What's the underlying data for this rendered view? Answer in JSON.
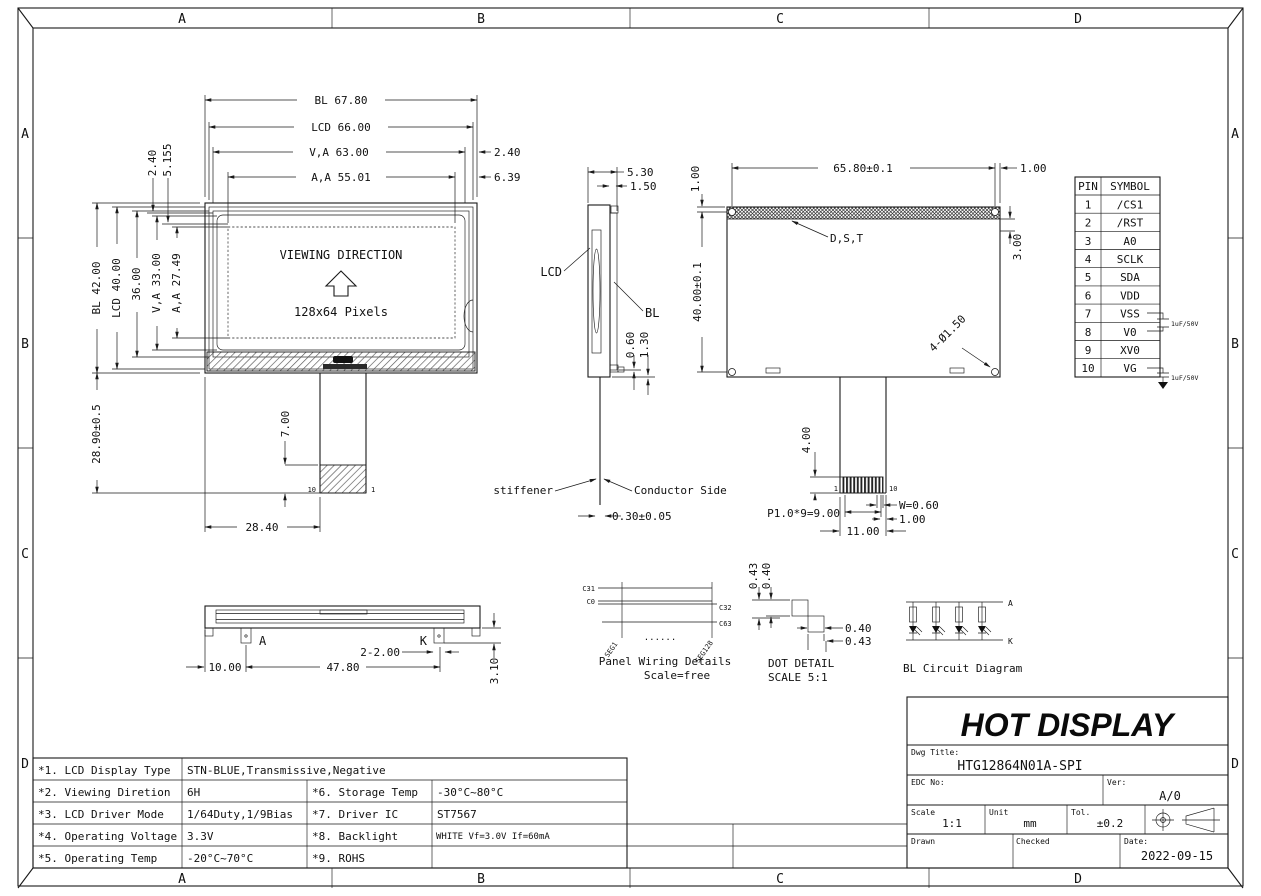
{
  "colors": {
    "line": "#1a1a1a",
    "paper": "#ffffff"
  },
  "border": {
    "letters": [
      "A",
      "B",
      "C",
      "D"
    ]
  },
  "front_view": {
    "dim_bl_w": "BL 67.80",
    "dim_lcd_w": "LCD 66.00",
    "dim_va_w": "V,A 63.00",
    "dim_aa_w": "A,A 55.01",
    "dim_240_right": "2.40",
    "dim_639": "6.39",
    "dim_bl_h": "BL 42.00",
    "dim_lcd_h": "LCD 40.00",
    "dim_36": "36.00",
    "dim_va_h": "V,A 33.00",
    "dim_aa_h": "A,A 27.49",
    "dim_240_top": "2.40",
    "dim_5155": "5.155",
    "dim_2890": "28.90±0.5",
    "dim_700": "7.00",
    "dim_2840": "28.40",
    "viewing_direction": "VIEWING DIRECTION",
    "pixels": "128x64 Pixels",
    "pin10": "10",
    "pin1": "1"
  },
  "side_view": {
    "dim_530": "5.30",
    "dim_150": "1.50",
    "label_lcd": "LCD",
    "label_bl": "BL",
    "dim_060": "0.60",
    "dim_130": "1.30",
    "label_stiffener": "stiffener",
    "label_conductor": "Conductor Side",
    "dim_030": "0.30±0.05"
  },
  "rear_view": {
    "dim_6580": "65.80±0.1",
    "dim_100_tr": "1.00",
    "dim_100_tl": "1.00",
    "dim_4000": "40.00±0.1",
    "dim_300": "3.00",
    "label_dst": "D,S,T",
    "dim_holes": "4-Ø1.50",
    "dim_400": "4.00",
    "pin1": "1",
    "pin10": "10",
    "dim_w": "W=0.60",
    "dim_pitch": "P1.0*9=9.00",
    "dim_100_b": "1.00",
    "dim_1100": "11.00"
  },
  "pin_table": {
    "headers": [
      "PIN",
      "SYMBOL"
    ],
    "rows": [
      [
        "1",
        "/CS1"
      ],
      [
        "2",
        "/RST"
      ],
      [
        "3",
        "A0"
      ],
      [
        "4",
        "SCLK"
      ],
      [
        "5",
        "SDA"
      ],
      [
        "6",
        "VDD"
      ],
      [
        "7",
        "VSS"
      ],
      [
        "8",
        "V0"
      ],
      [
        "9",
        "XV0"
      ],
      [
        "10",
        "VG"
      ]
    ],
    "cap_89": "1uF/50V",
    "cap_10": "1uF/50V"
  },
  "bottom_view": {
    "label_a": "A",
    "label_k": "K",
    "dim_1000": "10.00",
    "dim_4780": "47.80",
    "dim_2200": "2-2.00",
    "dim_310": "3.10"
  },
  "panel_wiring": {
    "c31": "C31",
    "c0": "C0",
    "c32": "C32",
    "c63": "C63",
    "seg1": "SEG1",
    "seg128": "SEG128",
    "dots": "......",
    "title": "Panel Wiring Details",
    "scale": "Scale=free"
  },
  "dot_detail": {
    "d043_v": "0.43",
    "d040_v": "0.40",
    "d040_h": "0.40",
    "d043_h": "0.43",
    "title": "DOT DETAIL",
    "scale": "SCALE 5:1"
  },
  "bl_circuit": {
    "label_a": "A",
    "label_k": "K",
    "title": "BL Circuit Diagram"
  },
  "title_block": {
    "company": "HOT DISPLAY",
    "dwg_title_label": "Dwg Title:",
    "dwg_title": "HTG12864N01A-SPI",
    "edc_label": "EDC No:",
    "ver_label": "Ver:",
    "ver": "A/0",
    "scale_label": "Scale",
    "scale": "1:1",
    "unit_label": "Unit",
    "unit": "mm",
    "tol_label": "Tol.",
    "tol": "±0.2",
    "drawn_label": "Drawn",
    "checked_label": "Checked",
    "date_label": "Date:",
    "date": "2022-09-15"
  },
  "spec_table": {
    "rows": [
      {
        "k1": "*1. LCD Display Type",
        "v1": "STN-BLUE,Transmissive,Negative",
        "k2": "",
        "v2": ""
      },
      {
        "k1": "*2. Viewing Diretion",
        "v1": "6H",
        "k2": "*6. Storage Temp",
        "v2": "-30°C~80°C"
      },
      {
        "k1": "*3. LCD Driver Mode",
        "v1": "1/64Duty,1/9Bias",
        "k2": "*7. Driver IC",
        "v2": "ST7567"
      },
      {
        "k1": "*4. Operating Voltage",
        "v1": "3.3V",
        "k2": "*8. Backlight",
        "v2": "WHITE Vf=3.0V If=60mA"
      },
      {
        "k1": "*5. Operating Temp",
        "v1": "-20°C~70°C",
        "k2": "*9. ROHS",
        "v2": ""
      }
    ]
  }
}
